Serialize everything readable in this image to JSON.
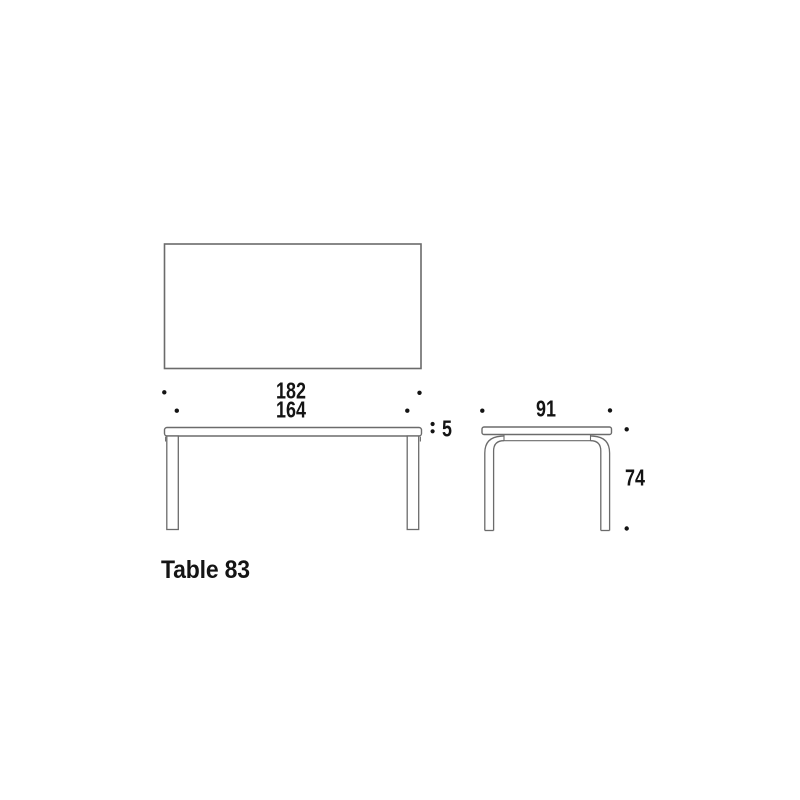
{
  "product": {
    "title": "Table 83"
  },
  "dimensions": {
    "top_length": "182",
    "leg_span_length": "164",
    "top_thickness": "5",
    "top_depth": "91",
    "height": "74"
  },
  "colors": {
    "background": "#ffffff",
    "line": "#6b6b6b",
    "text": "#141414",
    "dot": "#141414"
  }
}
